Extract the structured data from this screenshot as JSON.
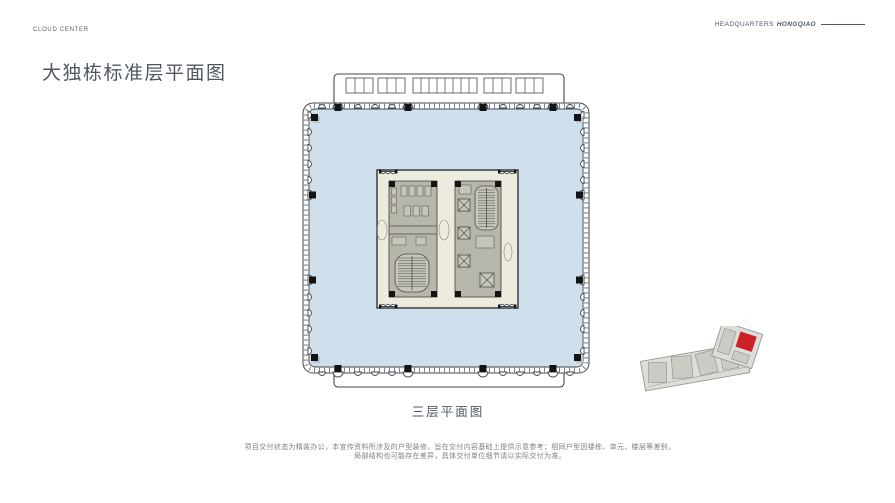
{
  "header": {
    "brand": "CLOUD CENTER",
    "right_label": "HEADQUARTERS",
    "right_label_italic": "HONGQIAO"
  },
  "title": "大独栋标准层平面图",
  "floorplan": {
    "caption": "三层平面图"
  },
  "disclaimer": {
    "line1": "项目交付状态为精装办公，本宣传资料所涉及的户型装修，旨在交付内容基础上提供示意参考；相同户型因楼栋、单元、楼层等差别，",
    "line2": "局部结构也可能存在差异，具体交付单位细节请以实际交付为准。"
  },
  "colors": {
    "floor_fill": "#cfe0ec",
    "core_fill": "#edebdd",
    "core_block_fill": "#b7b6ac",
    "core_inner_fill": "#c6c5bb",
    "outline": "#43484e",
    "detail_line": "#6b6961",
    "locator_fill": "#dcdcd8",
    "locator_inner": "#cbcbc5",
    "locator_outline": "#90908a",
    "highlight_red": "#cb2127",
    "text_dark": "#4e5761",
    "text_gray": "#7f7f7f"
  }
}
